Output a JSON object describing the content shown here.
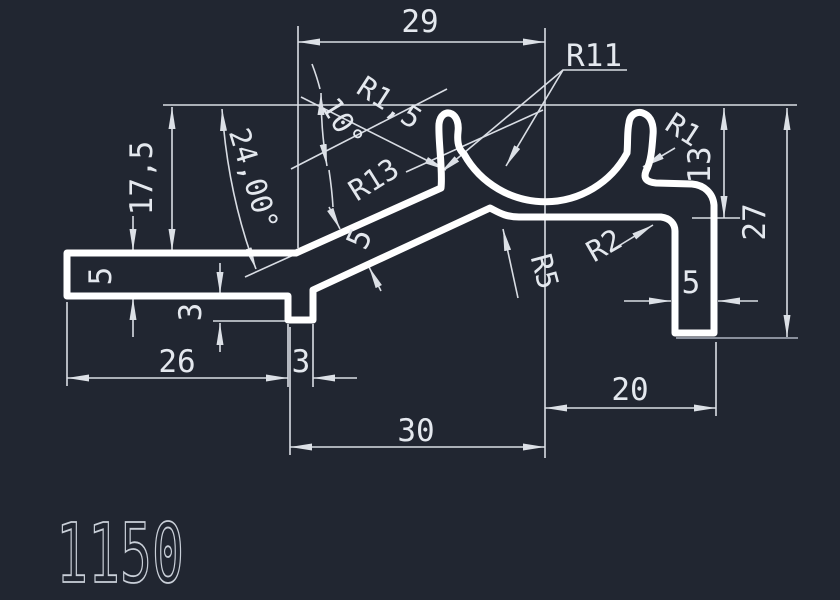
{
  "drawing": {
    "part_number": "1150",
    "background_color": "#212631",
    "geometry_color": "#ffffff",
    "dimension_color": "#e4e8ee",
    "faint_line_color": "#99a0ab",
    "labels": {
      "width_top": "29",
      "width_bottom": "30",
      "width_right": "20",
      "width_left_bar": "26",
      "tooth_width": "3",
      "tooth_depth": "3",
      "bar_thickness": "5",
      "arm_thickness": "5",
      "leg_width": "5",
      "height_left": "17,5",
      "height_step": "13",
      "height_total": "27",
      "angle_arm": "24,00°",
      "angle_lip": "10°",
      "radius_lip_left": "R1,5",
      "radius_arm_fillet": "R13",
      "radius_cradle": "R11",
      "radius_lip_right": "R1",
      "radius_step": "R2",
      "radius_saddle": "R5"
    }
  }
}
